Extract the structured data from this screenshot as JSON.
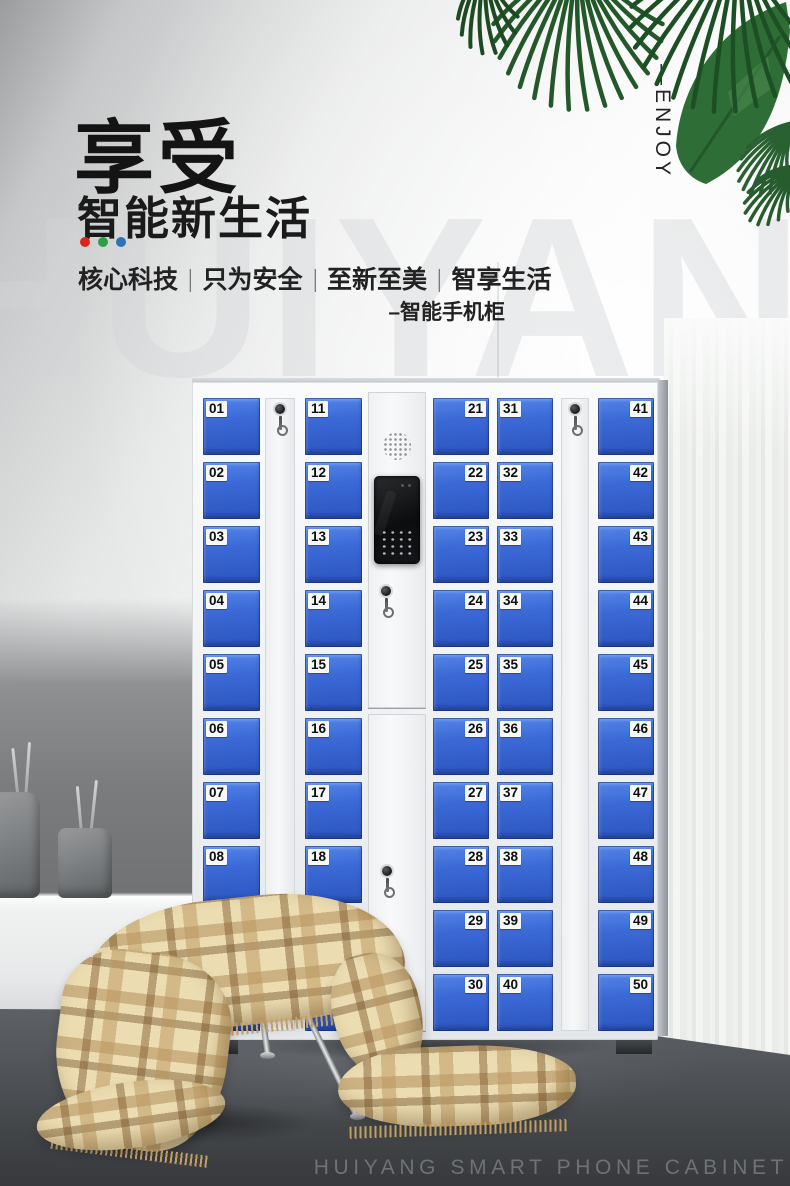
{
  "header": {
    "title": "享受",
    "subtitle": "智能新生活",
    "accent_dots": [
      "#d8281e",
      "#2d9e44",
      "#2b74b8"
    ],
    "tagline": [
      "核心科技",
      "只为安全",
      "至新至美",
      "智享生活"
    ],
    "tagline_divider": "|",
    "product_note": "–智能手机柜",
    "side_label": "—ENJOY",
    "watermark": "HUIYANG"
  },
  "locker": {
    "door_color": "#3b69d6",
    "door_columns": [
      {
        "name": "column-1",
        "label_side": "left",
        "doors": [
          "01",
          "02",
          "03",
          "04",
          "05",
          "06",
          "07",
          "08",
          "09",
          "10"
        ]
      },
      {
        "name": "column-2",
        "label_side": "left",
        "doors": [
          "11",
          "12",
          "13",
          "14",
          "15",
          "16",
          "17",
          "18",
          "19",
          "20"
        ]
      },
      {
        "name": "column-3",
        "label_side": "right",
        "doors": [
          "21",
          "22",
          "23",
          "24",
          "25",
          "26",
          "27",
          "28",
          "29",
          "30"
        ]
      },
      {
        "name": "column-4",
        "label_side": "left",
        "doors": [
          "31",
          "32",
          "33",
          "34",
          "35",
          "36",
          "37",
          "38",
          "39",
          "40"
        ]
      },
      {
        "name": "column-5",
        "label_side": "right",
        "doors": [
          "41",
          "42",
          "43",
          "44",
          "45",
          "46",
          "47",
          "48",
          "49",
          "50"
        ]
      }
    ]
  },
  "palette": {
    "leaf_green": "#2c6533",
    "blanket_base": "#ecdcb2",
    "cushion_mint": "#b3c6b8"
  },
  "footer": {
    "caption": "HUIYANG SMART PHONE CABINET"
  }
}
